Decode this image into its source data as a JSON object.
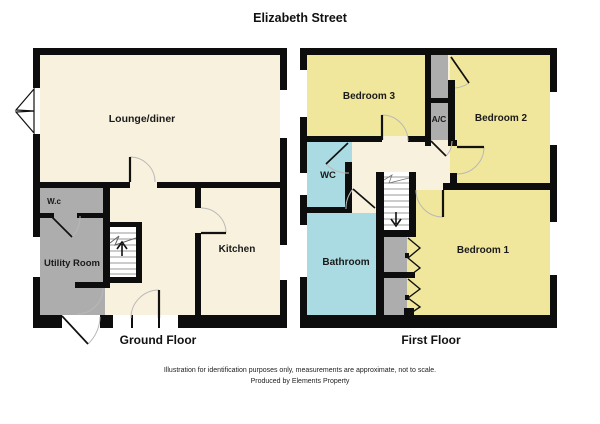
{
  "title": "Elizabeth Street",
  "colors": {
    "wall": "#0d0d0d",
    "floor_cream": "#f8f1de",
    "room_yellow": "#f0e79d",
    "room_blue": "#abdbe2",
    "room_gray": "#adadad"
  },
  "ground_floor": {
    "caption": "Ground Floor",
    "rooms": {
      "lounge": "Lounge/diner",
      "wc": "W.c",
      "utility": "Utility Room",
      "kitchen": "Kitchen"
    }
  },
  "first_floor": {
    "caption": "First Floor",
    "rooms": {
      "bedroom3": "Bedroom 3",
      "ac": "A/C",
      "bedroom2": "Bedroom 2",
      "wc": "WC",
      "bathroom": "Bathroom",
      "bedroom1": "Bedroom 1"
    }
  },
  "footer": {
    "line1": "Illustration for identification purposes only, measurements are approximate, not to scale.",
    "line2": "Produced by Elements Property"
  }
}
